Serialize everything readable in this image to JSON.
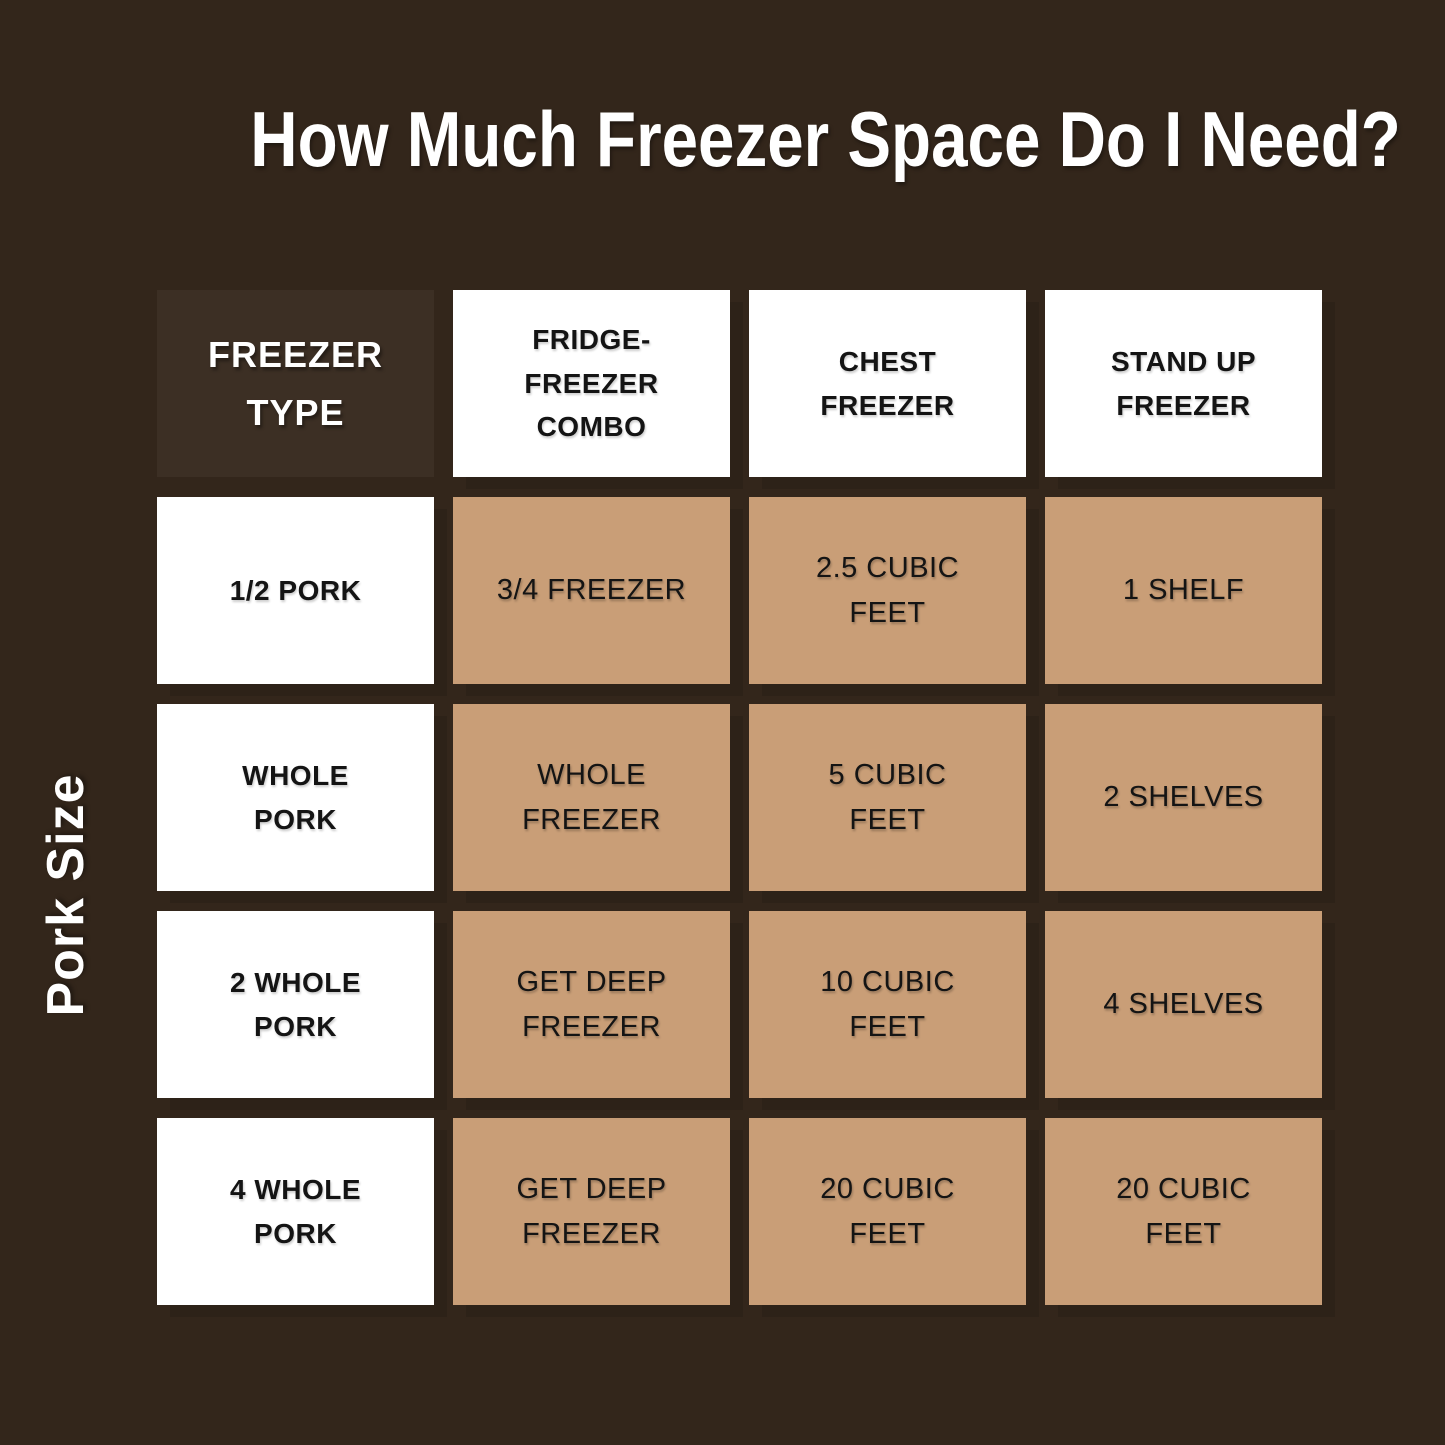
{
  "page": {
    "title": "How Much Freezer Space Do I Need?",
    "y_axis_label": "Pork Size"
  },
  "table": {
    "corner_header": "FREEZER\nTYPE",
    "column_headers": [
      "FRIDGE-\nFREEZER\nCOMBO",
      "CHEST\nFREEZER",
      "STAND UP\nFREEZER"
    ],
    "rows": [
      {
        "label": "1/2 PORK",
        "cells": [
          "3/4 FREEZER",
          "2.5 CUBIC\nFEET",
          "1 SHELF"
        ]
      },
      {
        "label": "WHOLE\nPORK",
        "cells": [
          "WHOLE\nFREEZER",
          "5 CUBIC\nFEET",
          "2 SHELVES"
        ]
      },
      {
        "label": "2 WHOLE\nPORK",
        "cells": [
          "GET DEEP\nFREEZER",
          "10 CUBIC\nFEET",
          "4 SHELVES"
        ]
      },
      {
        "label": "4 WHOLE\nPORK",
        "cells": [
          "GET DEEP\nFREEZER",
          "20 CUBIC\nFEET",
          "20 CUBIC\nFEET"
        ]
      }
    ]
  },
  "chart_data": {
    "type": "table",
    "title": "How Much Freezer Space Do I Need?",
    "row_axis_label": "Pork Size",
    "corner_label": "FREEZER TYPE",
    "columns": [
      "FRIDGE-FREEZER COMBO",
      "CHEST FREEZER",
      "STAND UP FREEZER"
    ],
    "row_labels": [
      "1/2 PORK",
      "WHOLE PORK",
      "2 WHOLE PORK",
      "4 WHOLE PORK"
    ],
    "values": [
      [
        "3/4 FREEZER",
        "2.5 CUBIC FEET",
        "1 SHELF"
      ],
      [
        "WHOLE FREEZER",
        "5 CUBIC FEET",
        "2 SHELVES"
      ],
      [
        "GET DEEP FREEZER",
        "10 CUBIC FEET",
        "4 SHELVES"
      ],
      [
        "GET DEEP FREEZER",
        "20 CUBIC FEET",
        "20 CUBIC FEET"
      ]
    ],
    "legend_position": "none",
    "grid": false
  },
  "colors": {
    "background": "#33261B",
    "corner_cell_bg": "#3C2F24",
    "header_cell_bg": "#FFFFFF",
    "data_cell_bg": "#C99E77",
    "title_text": "#FFFFFF",
    "cell_text": "#141414"
  }
}
